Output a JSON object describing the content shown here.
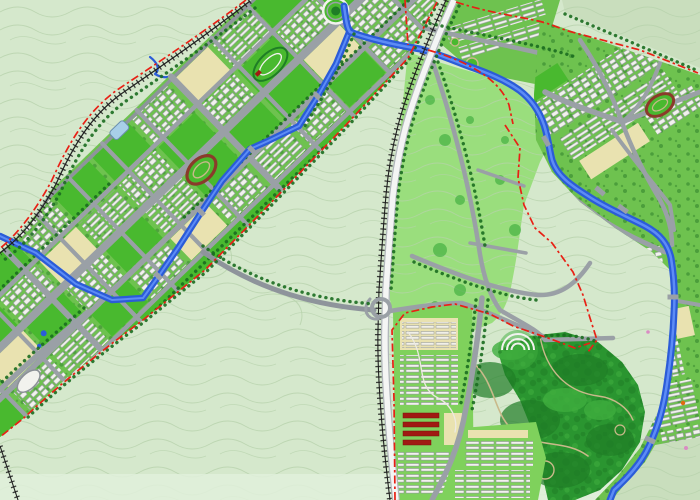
{
  "meta": {
    "app": "urban-master-plan-map",
    "description": "Rendered urban master plan of a linear new town: a diagonal city corridor with canal in a green valley, central park, forest park, riverside districts and red dash-dot planning boundaries",
    "canvas": {
      "width": 700,
      "height": 500
    },
    "visible_text": []
  },
  "palette": {
    "terrain": "#d5e8cc",
    "terrain-shade": "#c9debd",
    "terrain-band": "#e0f0da",
    "contour": "#b7d2ab",
    "city-green": "#6ec24f",
    "lawn-green": "#49b92f",
    "lawn-light": "#7fd15c",
    "park-green": "#9ade7d",
    "park-texture": "#84cf68",
    "forest-green": "#2a9530",
    "forest-dark": "#1f7d26",
    "forest-light": "#3fae3e",
    "tree": "#1b6d20",
    "road": "#9aa0a6",
    "road-dark": "#8e949b",
    "expressway": "#f4f5f4",
    "expressway-edge": "#b0b6ba",
    "railway": "#1f1f1f",
    "water": "#2b5cd8",
    "water-light": "#5d8cf5",
    "boundary-red": "#e82015",
    "building-white": "#f2f2ee",
    "building-shadow": "#8b9096",
    "beige": "#e9e2b0",
    "beige-dark": "#b5a878",
    "red-roof": "#a01a12",
    "stadium-ring": "#8a3b2a",
    "track-tan": "#c9b98a",
    "glass-blue": "#a8cfe8",
    "slab-gray": "#dcdcd6"
  },
  "features": {
    "districts": [
      {
        "id": "northwest-linear-city",
        "kind": "urban-corridor",
        "fill": "city-green"
      },
      {
        "id": "canal-north-housing",
        "kind": "rowhouse-strip",
        "fill": "city-green"
      },
      {
        "id": "eastern-riverside-district",
        "kind": "mixed-urban",
        "fill": "city-green"
      },
      {
        "id": "southwestern-housing-district",
        "kind": "rowhouse-district",
        "fill": "lawn-light"
      },
      {
        "id": "southern-terrace-housing",
        "kind": "rowhouse-zone",
        "fill": "lawn-light"
      },
      {
        "id": "central-park",
        "kind": "park",
        "fill": "park-green"
      },
      {
        "id": "forest-park",
        "kind": "forest",
        "fill": "forest-green"
      },
      {
        "id": "open-countryside",
        "kind": "terrain-with-contours",
        "fill": "terrain"
      }
    ],
    "waterways": [
      {
        "id": "river",
        "color": "water"
      },
      {
        "id": "corridor-canal",
        "color": "water"
      },
      {
        "id": "hill-stream",
        "color": "water"
      },
      {
        "id": "ponds",
        "color": "water"
      }
    ],
    "transport": [
      {
        "id": "expressway",
        "color": "expressway"
      },
      {
        "id": "northwest-railway",
        "color": "railway"
      },
      {
        "id": "central-railway",
        "color": "railway"
      },
      {
        "id": "arterial-roads",
        "color": "road"
      },
      {
        "id": "tree-lined-avenues",
        "color": "tree"
      },
      {
        "id": "highway-interchange",
        "color": "road"
      }
    ],
    "boundaries": [
      {
        "id": "planning-boundary-northwest",
        "style": "red-dash-dot"
      },
      {
        "id": "planning-boundary-corridor-southeast",
        "style": "red-dash-dot"
      },
      {
        "id": "planning-boundary-park-ring",
        "style": "red-dash-dot"
      },
      {
        "id": "planning-boundary-eastern-district",
        "style": "red-dash-dot"
      },
      {
        "id": "planning-boundary-southwestern-district",
        "style": "red-dash-dot"
      }
    ],
    "landmarks": [
      {
        "id": "western-stadium",
        "ring": "stadium-ring"
      },
      {
        "id": "eastern-stadium",
        "ring": "stadium-ring"
      },
      {
        "id": "racetrack-oval",
        "ring": "forest-dark"
      },
      {
        "id": "circular-plaza",
        "ring": "building-white"
      },
      {
        "id": "glass-building",
        "fill": "glass-blue"
      },
      {
        "id": "oval-hall",
        "fill": "building-white"
      },
      {
        "id": "amphitheater",
        "fill": "building-white"
      },
      {
        "id": "red-roof-terraces",
        "fill": "red-roof"
      }
    ]
  }
}
